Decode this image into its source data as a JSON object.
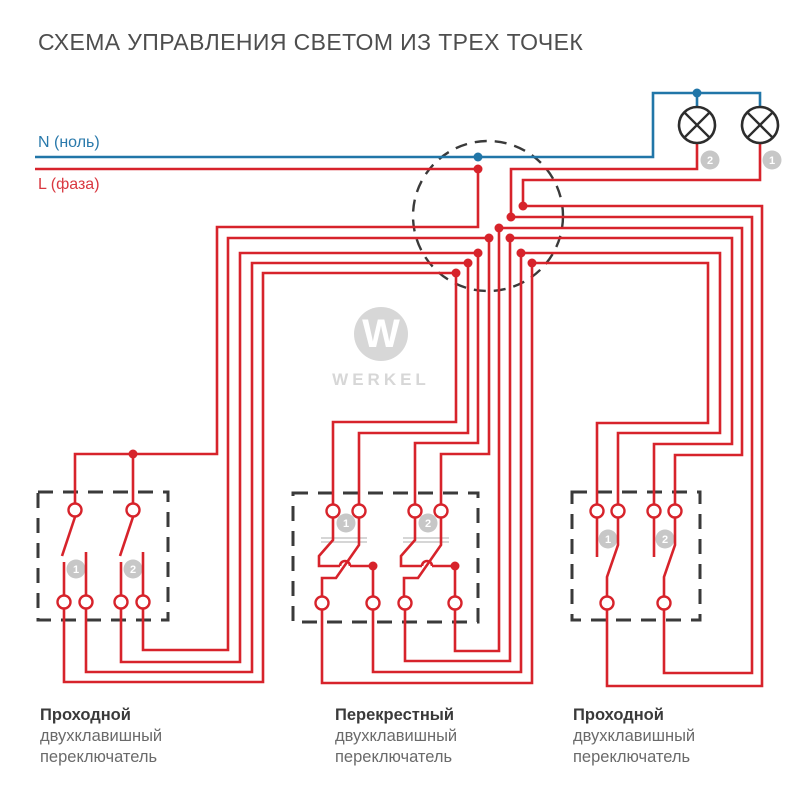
{
  "title": "СХЕМА УПРАВЛЕНИЯ СВЕТОМ ИЗ ТРЕХ ТОЧЕК",
  "legend": {
    "neutral": "N (ноль)",
    "phase": "L (фаза)"
  },
  "brand": {
    "mark": "W",
    "name": "WERKEL"
  },
  "colors": {
    "red": "#d7232b",
    "blue": "#2176a8",
    "box": "#3a3a3a",
    "lamp": "#2d2d2d",
    "badge": "#c7c7c7",
    "mechanism": "#bdbdbd"
  },
  "lamps": [
    {
      "id": "2",
      "cx": 697,
      "cy": 125,
      "badge_x": 710,
      "badge_y": 160
    },
    {
      "id": "1",
      "cx": 760,
      "cy": 125,
      "badge_x": 772,
      "badge_y": 160
    }
  ],
  "junction_box": {
    "cx": 488,
    "cy": 216,
    "r": 75,
    "red_dots": [
      [
        478,
        169
      ],
      [
        523,
        206
      ],
      [
        511,
        217
      ],
      [
        499,
        228
      ],
      [
        489,
        238
      ],
      [
        510,
        238
      ],
      [
        478,
        253
      ],
      [
        521,
        253
      ],
      [
        468,
        263
      ],
      [
        532,
        263
      ],
      [
        456,
        273
      ]
    ],
    "blue_dots": [
      [
        478,
        157
      ],
      [
        697,
        93
      ]
    ]
  },
  "extra_red_dots": [
    [
      133,
      454
    ],
    [
      373,
      566
    ],
    [
      455,
      566
    ]
  ],
  "switch_boxes": [
    {
      "x": 38,
      "y": 492,
      "w": 130,
      "h": 128
    },
    {
      "x": 293,
      "y": 493,
      "w": 185,
      "h": 129
    },
    {
      "x": 572,
      "y": 492,
      "w": 128,
      "h": 128
    }
  ],
  "key_badges": [
    [
      76,
      569,
      "1"
    ],
    [
      133,
      569,
      "2"
    ],
    [
      346,
      523,
      "1"
    ],
    [
      428,
      523,
      "2"
    ],
    [
      608,
      539,
      "1"
    ],
    [
      665,
      539,
      "2"
    ]
  ],
  "terminals": [
    [
      75,
      510
    ],
    [
      133,
      510
    ],
    [
      64,
      602
    ],
    [
      86,
      602
    ],
    [
      121,
      602
    ],
    [
      143,
      602
    ],
    [
      333,
      511
    ],
    [
      359,
      511
    ],
    [
      415,
      511
    ],
    [
      441,
      511
    ],
    [
      322,
      603
    ],
    [
      373,
      603
    ],
    [
      405,
      603
    ],
    [
      455,
      603
    ],
    [
      597,
      511
    ],
    [
      618,
      511
    ],
    [
      654,
      511
    ],
    [
      675,
      511
    ],
    [
      607,
      603
    ],
    [
      664,
      603
    ]
  ],
  "wires": {
    "blue": [
      "M35,157 H653 V93 H760 V107",
      "M697,93 V107"
    ],
    "red": [
      "M35,169 H478",
      "M478,169 V227 H217 V454 H75 V503",
      "M133,454 V503",
      "M64,609 V682 H263 V273 H456 V422 H333 V504",
      "M86,609 V672 H252 V263 H468 V433 H359 V504",
      "M121,609 V662 H240 V253 H478 V443 H415 V504",
      "M143,609 V650 H228 V238 H489 V454 H441 V504",
      "M322,610 V683 H532 V263 H708 V423 H597 V504",
      "M373,610 V672 H521 V253 H720 V433 H618 V504",
      "M405,610 V661 H510 V238 H732 V444 H654 V504",
      "M455,610 V651 H499 V228 H742 V455 H675 V504",
      "M607,610 V686 H762 V206 H523 V180 H760 V143",
      "M664,610 V673 H752 V217 H511 V169 H697 V143"
    ],
    "internal": [
      "M75,517 L62,556",
      "M64,562 V595",
      "M86,552 V595",
      "M133,517 L120,556",
      "M121,562 V595",
      "M143,552 V595",
      "M333,518 V540 L319,556 V566 H340",
      "M340,566 a5,5 0 0 1 10,0",
      "M350,566 H373 V596",
      "M359,518 V545 L336,578 H322 V596",
      "M415,518 V540 L401,556 V566 H422",
      "M422,566 a5,5 0 0 1 10,0",
      "M432,566 H455 V596",
      "M441,518 V545 L418,578 H404 V596",
      "M597,518 V557",
      "M618,518 V545 L607,577 V596",
      "M654,518 V557",
      "M675,518 V545 L664,577 V596"
    ],
    "mechanism": [
      "M321,538 H367",
      "M321,542 H367",
      "M403,538 H449",
      "M403,542 H449"
    ]
  },
  "footer": [
    {
      "title": "Проходной",
      "line2": "двухклавишный",
      "line3": "переключатель"
    },
    {
      "title": "Перекрестный",
      "line2": "двухклавишный",
      "line3": "переключатель"
    },
    {
      "title": "Проходной",
      "line2": "двухклавишный",
      "line3": "переключатель"
    }
  ]
}
